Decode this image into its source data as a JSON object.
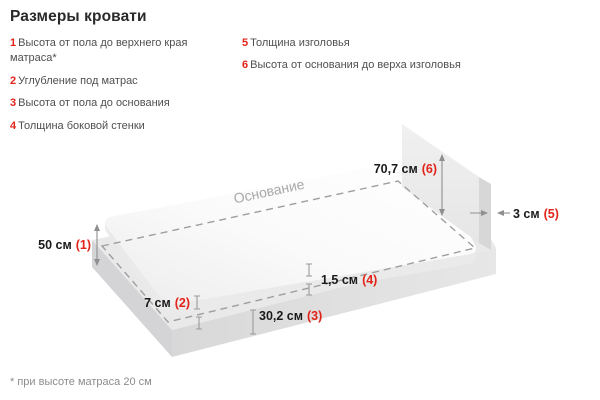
{
  "title": "Размеры кровати",
  "accent_color": "#e2231a",
  "legend": {
    "left": [
      {
        "num": "1",
        "label": "Высота от пола до верхнего края матраса*"
      },
      {
        "num": "2",
        "label": "Углубление под матрас"
      },
      {
        "num": "3",
        "label": "Высота от пола до основания"
      },
      {
        "num": "4",
        "label": "Толщина боковой стенки"
      }
    ],
    "right": [
      {
        "num": "5",
        "label": "Толщина изголовья"
      },
      {
        "num": "6",
        "label": "Высота от основания до верха изголовья"
      }
    ]
  },
  "diagram": {
    "base_label": "Основание",
    "dimensions": [
      {
        "value": "50 см",
        "ref": "(1)"
      },
      {
        "value": "7 см",
        "ref": "(2)"
      },
      {
        "value": "30,2 см",
        "ref": "(3)"
      },
      {
        "value": "1,5 см",
        "ref": "(4)"
      },
      {
        "value": "3 см",
        "ref": "(5)"
      },
      {
        "value": "70,7 см",
        "ref": "(6)"
      }
    ]
  },
  "footnote": "* при высоте матраса 20 см"
}
